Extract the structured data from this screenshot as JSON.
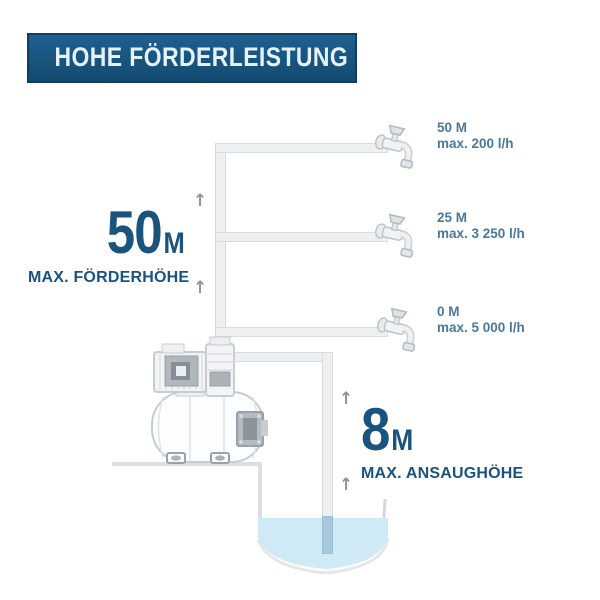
{
  "banner": {
    "title": "HOHE FÖRDERLEISTUNG"
  },
  "outlets": [
    {
      "height": "50 M",
      "flow": "max. 200 l/h"
    },
    {
      "height": "25 M",
      "flow": "max. 3 250 l/h"
    },
    {
      "height": "0 M",
      "flow": "max. 5 000 l/h"
    }
  ],
  "delivery_head": {
    "value": "50",
    "unit": "M",
    "caption": "MAX. FÖRDERHÖHE"
  },
  "suction_head": {
    "value": "8",
    "unit": "M",
    "caption": "MAX. ANSAUGHÖHE"
  },
  "icons": {
    "up_arrow": "↑",
    "faucet": "faucet-icon",
    "pump": "pump-illustration"
  },
  "colors": {
    "banner_bg": "#175179",
    "banner_text": "#e6f2fb",
    "headline_blue": "#1b537f",
    "label_blue": "#49789d",
    "pipe_fill": "#edeff1",
    "water": "#cfe9f6"
  }
}
